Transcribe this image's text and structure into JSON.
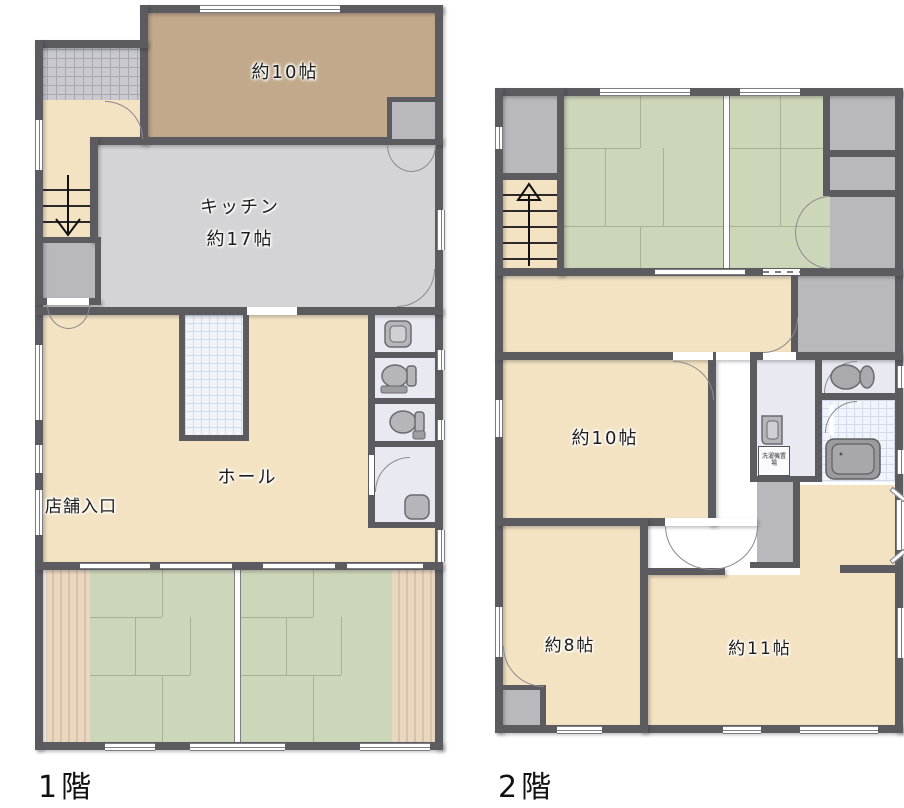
{
  "floor1": {
    "label": "1階",
    "rooms": {
      "room10": "約10帖",
      "kitchen_name": "キッチン",
      "kitchen_size": "約17帖",
      "hall": "ホール",
      "shop_entrance": "店舗入口"
    }
  },
  "floor2": {
    "label": "2階",
    "rooms": {
      "room10": "約10帖",
      "room8": "約8帖",
      "room11": "約11帖",
      "laundry": "洗濯機置場"
    }
  },
  "colors": {
    "wall": "#5b5b60",
    "tatami_green": "#ccd7b9",
    "flooring_cream": "#f3e3c2",
    "kitchen_gray": "#d4d4d6",
    "room_tan": "#c2a98b",
    "closet_gray": "#b9b9bd",
    "sanitary_lavender": "#e9e9f1",
    "wood_edge": "#e6d4bf",
    "tile_white": "#f1f4fa"
  }
}
